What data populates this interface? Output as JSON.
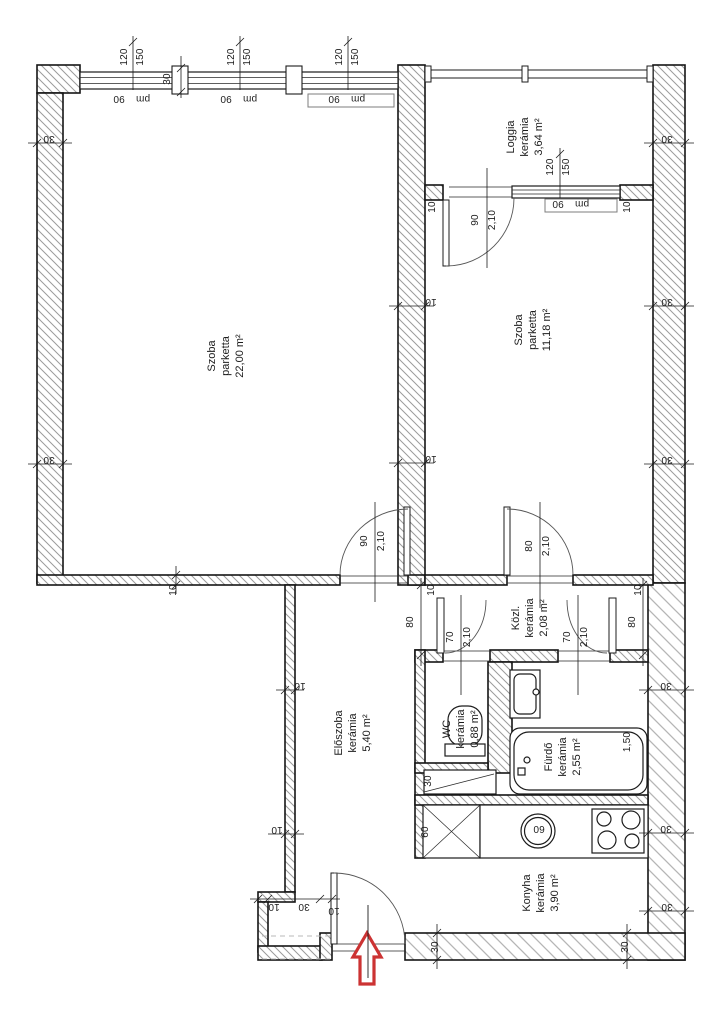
{
  "rooms": {
    "szoba_nagy": {
      "name": "Szoba",
      "material": "parketta",
      "area": "22,00 m²"
    },
    "szoba_kis": {
      "name": "Szoba",
      "material": "parketta",
      "area": "11,18 m²"
    },
    "loggia": {
      "name": "Loggia",
      "material": "kerámia",
      "area": "3,64 m²"
    },
    "kozlekedo": {
      "name": "Közl.",
      "material": "kerámia",
      "area": "2,08 m²"
    },
    "wc": {
      "name": "WC",
      "material": "kerámia",
      "area": "0,88 m²"
    },
    "furdo": {
      "name": "Fürdő",
      "material": "kerámia",
      "area": "2,55 m²"
    },
    "eloszoba": {
      "name": "Előszoba",
      "material": "kerámia",
      "area": "5,40 m²"
    },
    "konyha": {
      "name": "Konyha",
      "material": "kerámia",
      "area": "3,90 m²"
    }
  },
  "dims": {
    "n120": "120",
    "n150": "150",
    "n90": "90",
    "pm": "pm",
    "n210": "2,10",
    "n80": "80",
    "n70": "70",
    "n30": "30",
    "n10": "10",
    "n60": "60",
    "n150b": "1,50"
  },
  "colors": {
    "line": "#1c1c1c",
    "hatch": "#9b9b9b",
    "hatch_light": "#b5b5b5",
    "arrow_red": "#cc3333",
    "background": "#ffffff"
  }
}
